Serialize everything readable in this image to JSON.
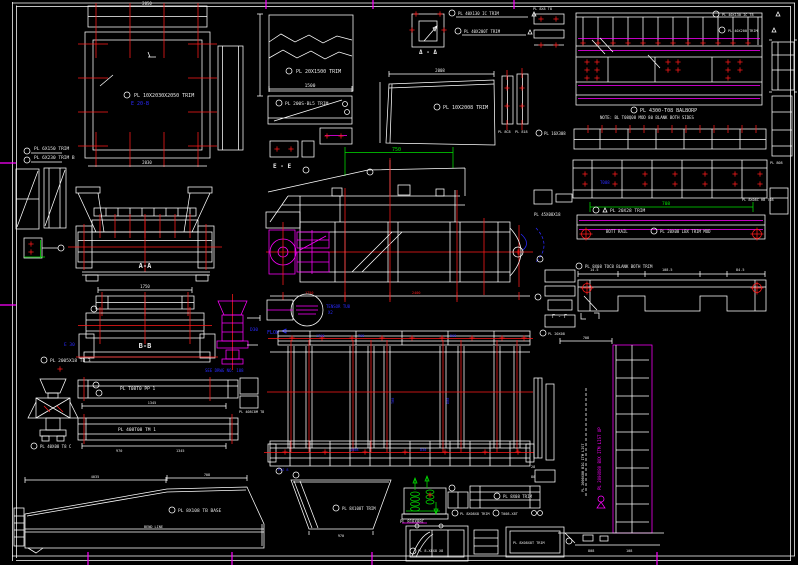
{
  "colors": {
    "background": "#000000",
    "linework": "#ffffff",
    "centerline_red": "#ff1a1a",
    "accent_magenta": "#ff00ff",
    "accent_green": "#00e000",
    "accent_blue": "#2a2aff"
  },
  "labels": {
    "sq_top_dim": "2050",
    "sq_callout": "PL 10X2030X2050 TRIM",
    "sq_tag": "E 20-B",
    "sq_bot_dim": "2030",
    "sq_note1": "PL 6X150 TRIM",
    "sq_note2": "PL 6X230 TRIM B",
    "break_callout": "PL 20X1500 TRIM",
    "break_dim": "1500",
    "ee_label": "E - E",
    "sub_callout": "PL 200S-BL5 TRIM",
    "dd_label": "Δ - Δ",
    "dd_note1": "PL 40X130 IC TRIM",
    "dd_note2": "PL 40X200T TRIM",
    "mid_callout": "PL 10X2008 TRIM",
    "mid_dim": "2008",
    "green_dim": "750",
    "tr_note1": "PL 4300-T08 BALBORP",
    "tr_note2": "NOTE: BL T08Q08 MOD 80 BLANK BOTH SIDES",
    "trc1": "PL 40X130 IC T8",
    "trc2": "PL 40X200 TRIM",
    "tl_note": "PL 8X8 T8",
    "band2_note": "PL 16X308",
    "band3_tag": "T008",
    "b4_green": "708",
    "b4_callout": "PL 20X28 TRIM",
    "b4_right": "PL 8X08C HB T08",
    "b4_center": "BOTT RAIL",
    "b4_callout2": "PL 20X08 LBX TRIM MOD",
    "notch_callout": "PL 8X08 TOC8 BLANK BOTH TRIM",
    "notch_d1": "14.5",
    "notch_d2": "108.5",
    "notch_d3": "84.5",
    "gg_label": "Γ - Γ",
    "col_note": "PL 45X08X18",
    "rc_note": "PL 20X08",
    "aa_label": "A-A",
    "aa_dim": "1750",
    "bb_label": "B-B",
    "bb_tag": "E 30",
    "bb_note": "SEE DRWG NO. 108",
    "aa_foot": "PL 2005X18 TB 3",
    "vib_tag": "D30",
    "flow": "FLOW",
    "det1": "TENSOR TU8",
    "det2": "X2",
    "el_d1": "1750",
    "el_d2": "2400",
    "plan_t1": "1708",
    "plan_t2": "T08",
    "plan_t3": "D08",
    "plan_v1": "T08",
    "plan_v2": "D08",
    "rail_t1": "POS 8",
    "rail_t2": "1008",
    "rail_t3": "D30",
    "bar1_callout": "PL T08T0 PP 1",
    "bar_dim": "1345",
    "bar2_callout": "PL 408T08 TM 1",
    "bar2_d1": "970",
    "bar2_d2": "1345",
    "bar_right": "PL 408C8M T8",
    "mount_callout": "PL 40X08 T8 C",
    "trap_callout": "PL 8X108 TB BASE",
    "trap_dim": "BEND LINE",
    "trap_d1": "708",
    "trap_d2": "4035",
    "hopper_callout": "PL 8X108T TRIM",
    "hop_d": "970",
    "iso_callout": "PL 818X08C",
    "bar3_callout": "PL 8X08 TRIM",
    "small_note1": "PL 8X08X8 TRIM",
    "small_note2": "T008-X8T",
    "box2_label": "PL 8X08X8T TRIM",
    "box_callout": "PL 8-X8X8 X8",
    "br_top_d": "708",
    "vert_white": "PL 2000X80 BIG ITM LIST",
    "vert_mag": "PL 2000X80 BOX ITM LIST UP",
    "br_d1": "808",
    "br_d2": "108",
    "lc1": "28",
    "lc2": "80",
    "re_note": "PL 808",
    "bars_note1": "PL 8C8",
    "bars_note2": "PL 818"
  }
}
